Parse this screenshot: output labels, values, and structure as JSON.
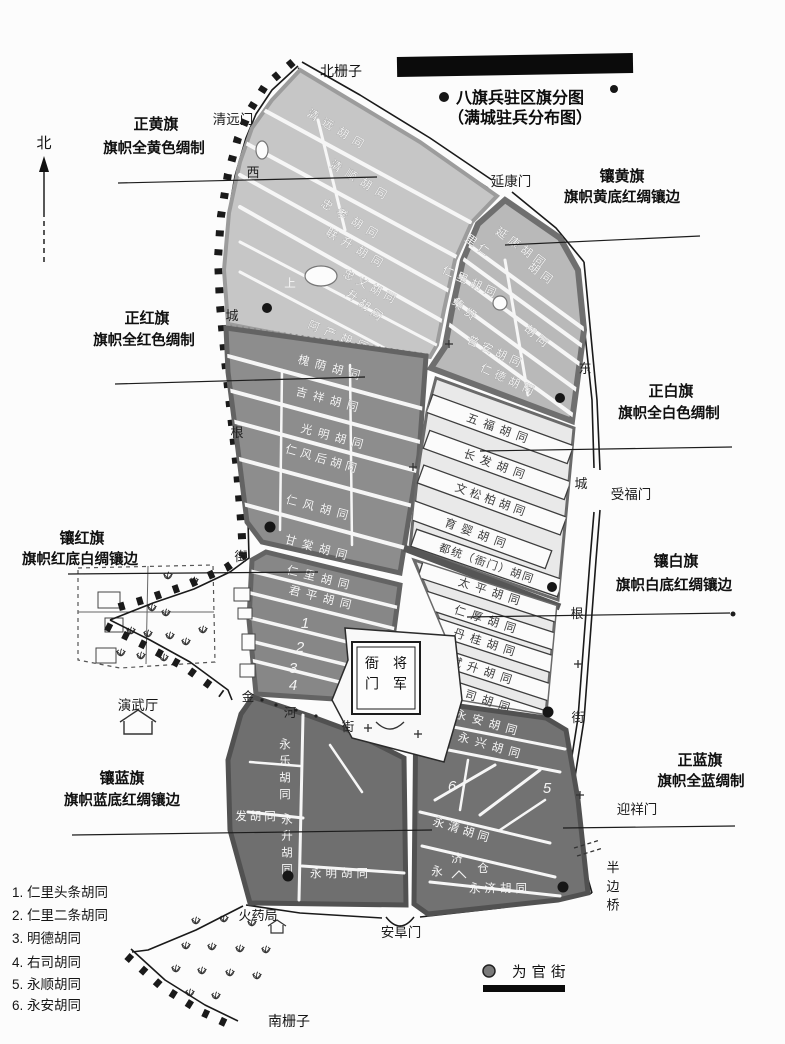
{
  "title": {
    "line1": "八旗兵驻区旗分图",
    "line2": "（满城驻兵分布图）"
  },
  "compass": {
    "north": "北"
  },
  "fences": {
    "north": "北栅子",
    "south": "南栅子"
  },
  "gates": {
    "qingyuanmen": "清远门",
    "yankangmen": "延康门",
    "shoufumen": "受福门",
    "yingxiangmen": "迎祥门",
    "anfumen": "安阜门"
  },
  "wall_streets": {
    "west": [
      "西",
      "城",
      "根",
      "街"
    ],
    "east": [
      "东",
      "城",
      "根",
      "街"
    ]
  },
  "banners": {
    "zhenghuang": {
      "name": "正黄旗",
      "desc": "旗帜全黄色绸制"
    },
    "xianghuang": {
      "name": "镶黄旗",
      "desc": "旗帜黄底红绸镶边"
    },
    "zhenghong": {
      "name": "正红旗",
      "desc": "旗帜全红色绸制"
    },
    "xianghong": {
      "name": "镶红旗",
      "desc": "旗帜红底白绸镶边"
    },
    "zhengbai": {
      "name": "正白旗",
      "desc": "旗帜全白色绸制"
    },
    "xiangbai": {
      "name": "镶白旗",
      "desc": "旗帜白底红绸镶边"
    },
    "zhenglan": {
      "name": "正蓝旗",
      "desc": "旗帜全蓝绸制"
    },
    "xianglan": {
      "name": "镶蓝旗",
      "desc": "旗帜蓝底红绸镶边"
    }
  },
  "hutongs": {
    "qingyuan": "清远胡同",
    "qingshun": "清顺胡同",
    "zhongxiao": "忠孝胡同",
    "liansheng": "联升胡同",
    "zhongyi": "忠义胡同",
    "shang": "上",
    "shenghutong": "升胡同",
    "achan": "阿产胡同",
    "yankang": "延康胡同",
    "liren_a": "里仁",
    "liren_b": "胡同",
    "renli_xh": "仁里胡同",
    "jixian_a": "集贤",
    "jixian_b": "胡同",
    "puan": "普安胡同",
    "rende": "仁德胡同",
    "huaiyin": "槐荫胡同",
    "jixiang": "吉祥胡同",
    "guangming": "光明胡同",
    "renfenghou": "仁风后胡同",
    "renfeng": "仁风胡同",
    "gantang": "甘棠胡同",
    "renli": "仁里胡同",
    "junping": "君平胡同",
    "wufu": "五福胡同",
    "changfa": "长发胡同",
    "wensongbai": "文松柏胡同",
    "yuying": "育婴胡同",
    "dutong": "都统（衙门）胡同",
    "taiping": "太平胡同",
    "renhou": "仁厚胡同",
    "dangui": "丹桂胡同",
    "binsheng": "斌升胡同",
    "zuosi": "左司胡同",
    "yongan": "永安胡同",
    "yongxing": "永兴胡同",
    "yongqing": "永清胡同",
    "yongjih": "永济胡同",
    "yongle": "永乐胡同",
    "fa": "发胡同",
    "yongsheng": "永升胡同",
    "yongming": "永明胡同"
  },
  "map_numbers": {
    "n1": "1",
    "n2": "2",
    "n3": "3",
    "n4": "4",
    "n5": "5",
    "n6": "6"
  },
  "landmarks": {
    "yamen_right": "将军",
    "yamen_left": "衙门",
    "drill_hall": "演武厅",
    "powder_bureau": "火药局",
    "granary": [
      "永",
      "济",
      "仓"
    ],
    "gold": "金",
    "river": "河",
    "street": "街",
    "half_bridge": "半边桥"
  },
  "legend": {
    "marker_label": "为官街"
  },
  "notes": [
    "1. 仁里头条胡同",
    "2. 仁里二条胡同",
    "3. 明德胡同",
    "4. 右司胡同",
    "5. 永顺胡同",
    "6. 永安胡同"
  ],
  "colors": {
    "zhenghuang_fill": "#c6c6c6",
    "xianghuang_fill": "#b9b9b9",
    "zhenghong_fill": "#8d8d8d",
    "xianghong_fill": "#878787",
    "zhengbai_fill": "#e9e9e9",
    "xiangbai_fill": "#e9e9e9",
    "zhenglan_fill": "#727272",
    "xianglan_fill": "#6f6f6f",
    "ink": "#1a1a1a"
  }
}
